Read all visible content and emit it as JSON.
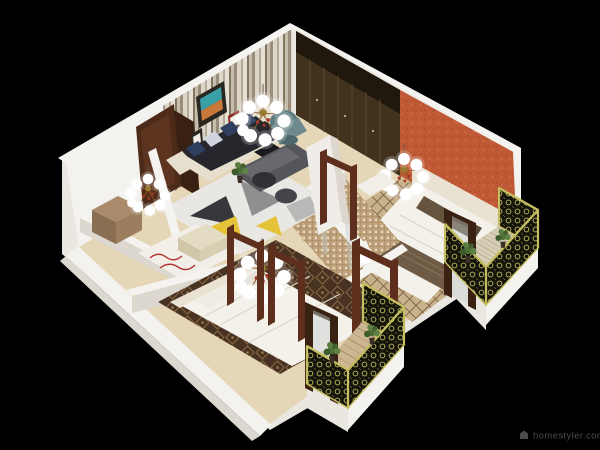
{
  "watermark": {
    "icon": "house-icon",
    "text": "homestyler.com"
  },
  "palette": {
    "bg": "#000000",
    "wall_top": "#f5f3ef",
    "wall_face": "#eae7e1",
    "wall_shade": "#dcd7cf",
    "wall_bright": "#f4f2ee",
    "wood_floor": "#e4d6b6",
    "wardrobe": "#41321e",
    "wardrobe_shadow": "#20170d",
    "orange_wall": "#c05a36",
    "door_brown": "#4e2b18",
    "frame_brown": "#5e2f1d",
    "sofa_shell": "#e7dfcd",
    "sofa_dark": "#26262c",
    "pillow_navy": "#2e3f60",
    "armchair_teal": "#5d7b80",
    "table_gray": "#55555c",
    "rug_yellow": "#e5c338",
    "carpet_bedroom1": "#c7b28c",
    "carpet_bedroom2": "#483322",
    "tile_bath": "#c4a67e",
    "bed_white": "#f4f1ea",
    "blanket_brown": "#6e5a45",
    "headboard": "#e9e1d1",
    "railing_gold": "#c5be60",
    "plant_green": "#4e7038",
    "box_brown": "#a98b6b",
    "bench_cream": "#e3dcc2",
    "glass": "#c6ced0",
    "globe": "#ffffff",
    "brass": "#9a7a30",
    "accent_red": "#a83828",
    "red_rug": "#b23230",
    "watermark_text": "#4c4c4a"
  }
}
